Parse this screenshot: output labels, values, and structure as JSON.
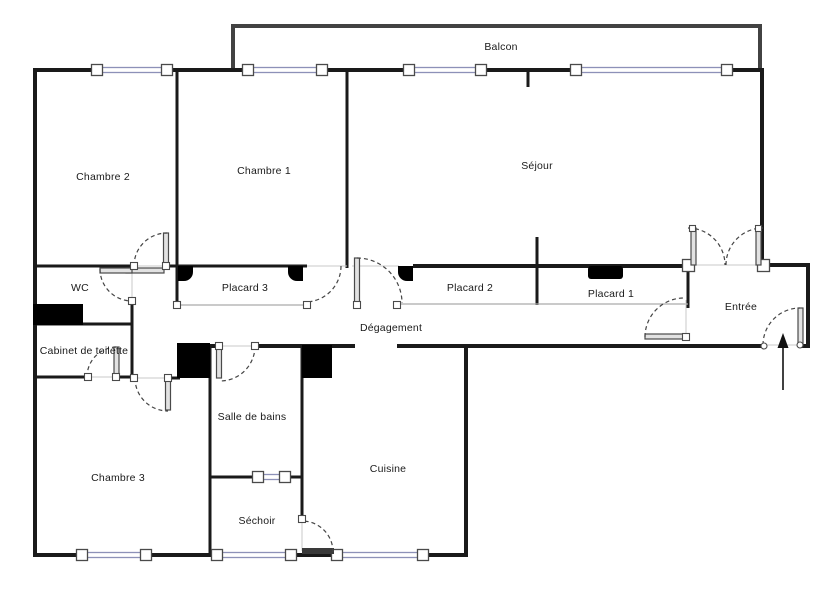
{
  "plan": {
    "type": "apartment-floor-plan",
    "rooms": {
      "balcon": {
        "label": "Balcon"
      },
      "chambre2": {
        "label": "Chambre 2"
      },
      "chambre1": {
        "label": "Chambre 1"
      },
      "sejour": {
        "label": "Séjour"
      },
      "wc": {
        "label": "WC"
      },
      "placard3": {
        "label": "Placard 3"
      },
      "placard2": {
        "label": "Placard 2"
      },
      "placard1": {
        "label": "Placard 1"
      },
      "entree": {
        "label": "Entrée"
      },
      "cabinet_de_toilette": {
        "label": "Cabinet de toilette"
      },
      "degagement": {
        "label": "Dégagement"
      },
      "salle_de_bains": {
        "label": "Salle de bains"
      },
      "chambre3": {
        "label": "Chambre 3"
      },
      "sechoir": {
        "label": "Séchoir"
      },
      "cuisine": {
        "label": "Cuisine"
      }
    },
    "colors": {
      "wall": "#1a1a1a",
      "window_frame": "#8d91b8",
      "balcony_rail": "#424242",
      "door_swing": "#444444",
      "fixture": "#000000",
      "background": "#ffffff",
      "label_text": "#1a1a1a"
    }
  }
}
